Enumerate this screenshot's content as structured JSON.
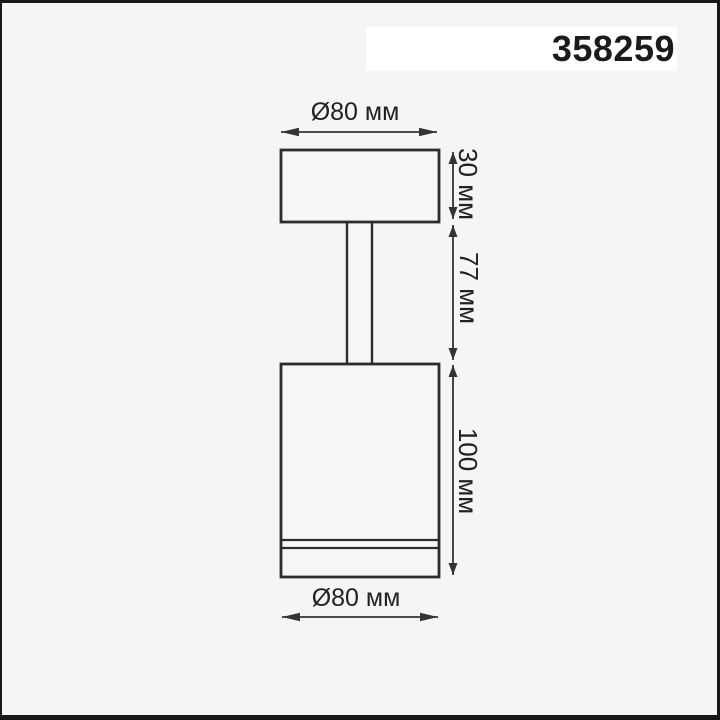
{
  "product": {
    "code": "358259"
  },
  "diagram": {
    "title": "luminaire-dimension-drawing",
    "dimensions": {
      "top_diameter": "Ø80 мм",
      "cap_height": "30 мм",
      "stem_height": "77 мм",
      "body_height": "100 мм",
      "bottom_diameter": "Ø80 мм"
    }
  },
  "colors": {
    "background": "#f5f5f5",
    "border": "#181818",
    "outline": "#2d2d2d",
    "dimension_line": "#333333",
    "label_text": "#222222",
    "code_band_background": "#ffffff",
    "code_text": "#1b1b1b"
  }
}
